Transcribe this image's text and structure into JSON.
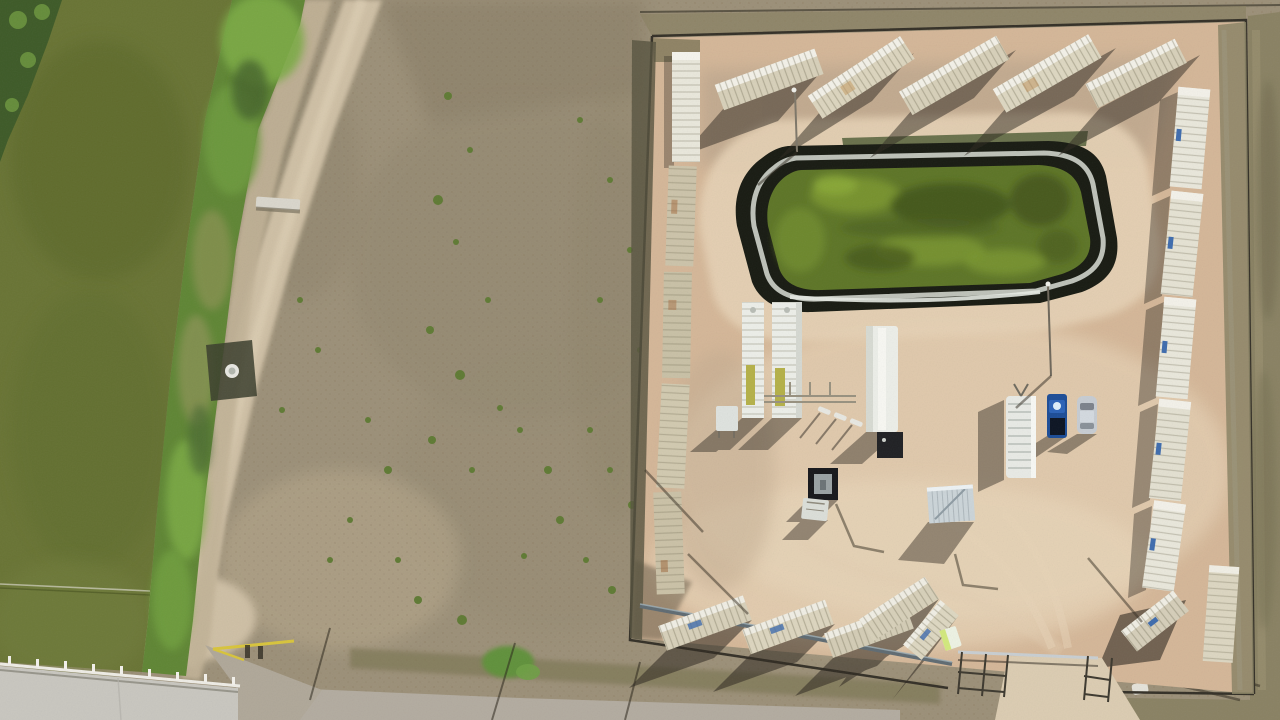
{
  "meta": {
    "type": "aerial-drone-photo",
    "subject": "Aerial top-down photo of a fenced oilfield equipment yard with a lined green retention pond, shipping containers around the perimeter, white tanks and trailers, a blue pickup and silver car, beside a green irrigation canal, scrub field and dirt roads",
    "image_width": 1280,
    "image_height": 720
  },
  "colors": {
    "field_base": "#9c9078",
    "field_dark": "#857b65",
    "field_light": "#b4a88d",
    "road_dirt": "#cfc0a5",
    "road_dirt_light": "#dccdb2",
    "road_gray": "#b3aca0",
    "concrete": "#c9c7c0",
    "canal_water": "#697434",
    "canal_water_dark": "#596627",
    "veg_bright": "#7cab45",
    "veg_mid": "#5f8634",
    "veg_dark": "#3d5a27",
    "bank_pale": "#c2b397",
    "compound_dirt": "#d5b798",
    "compound_dirt_light": "#e6d2b5",
    "compound_dirt_gray": "#b3a089",
    "grass_olive": "#8a8263",
    "fence_dark": "#332f26",
    "pond_liner": "#171a11",
    "pond_trim": "#d0d5cc",
    "pond_water": "#5d7526",
    "pond_water_light": "#7b972f",
    "pond_water_dark": "#41531a",
    "container_tan": "#d8d1ba",
    "container_white": "#eae8dc",
    "container_top": "#f4f2e9",
    "label_blue": "#3e6cae",
    "shadow": "#2e2820",
    "shed_metal": "#ccd5d9",
    "trailer_white": "#edefe9",
    "truck_blue": "#1b4c97",
    "car_silver": "#c7cdd3",
    "gate_yellow": "#d9c53b",
    "potty_green": "#d3e97d",
    "pipe_gray": "#62707a"
  },
  "inventory": {
    "water_features": [
      "irrigation-canal",
      "lined-retention-pond"
    ],
    "containers_top_row": 5,
    "containers_left_column": 5,
    "containers_right_column": 7,
    "containers_bottom_row": 5,
    "vehicles": [
      "blue-pickup-truck",
      "silver-car",
      "white-utility-trailer"
    ],
    "equipment": [
      "white-tank-a",
      "white-tank-b",
      "white-equipment-trailer",
      "black-skid-unit",
      "corrugated-shed",
      "portable-toilet"
    ],
    "structures": [
      "perimeter-fence",
      "entrance-gate",
      "concrete-canal-crossing",
      "yellow-pipe-gate",
      "dirt-road",
      "bottom-road"
    ]
  }
}
